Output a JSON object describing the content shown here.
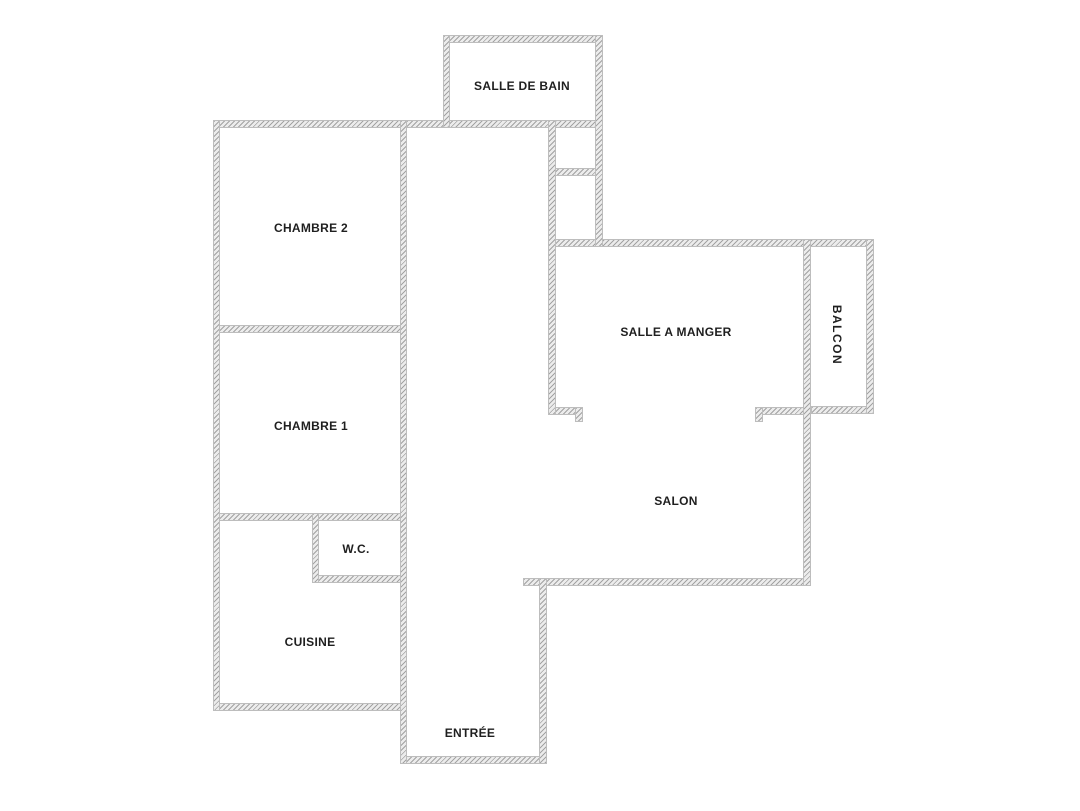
{
  "diagram": {
    "type": "apartment-floor-plan",
    "background_color": "#ffffff",
    "wall_fill_color": "#ececec",
    "wall_hatch_color": "#a3a3a3",
    "wall_edge_color": "#bdbdbd",
    "label_color": "#1f1f1f",
    "rooms": [
      {
        "id": "salle-de-bain",
        "label": "SALLE DE BAIN",
        "orientation": "horizontal"
      },
      {
        "id": "chambre-2",
        "label": "CHAMBRE 2",
        "orientation": "horizontal"
      },
      {
        "id": "chambre-1",
        "label": "CHAMBRE 1",
        "orientation": "horizontal"
      },
      {
        "id": "wc",
        "label": "W.C.",
        "orientation": "horizontal"
      },
      {
        "id": "cuisine",
        "label": "CUISINE",
        "orientation": "horizontal"
      },
      {
        "id": "entree",
        "label": "ENTRÉE",
        "orientation": "horizontal"
      },
      {
        "id": "salon",
        "label": "SALON",
        "orientation": "horizontal"
      },
      {
        "id": "salle-a-manger",
        "label": "SALLE A MANGER",
        "orientation": "horizontal"
      },
      {
        "id": "balcon",
        "label": "BALCON",
        "orientation": "vertical"
      }
    ]
  }
}
